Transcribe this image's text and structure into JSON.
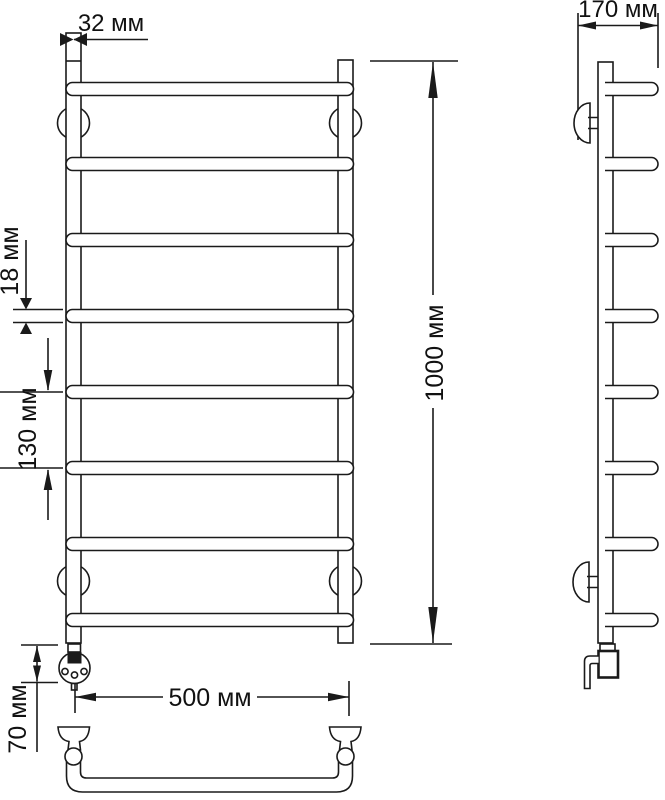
{
  "drawing": {
    "kind": "towel-rail-technical-drawing",
    "colors": {
      "line": "#1a1a1a",
      "background": "#ffffff"
    },
    "dimensions": {
      "tube_diameter": "32 мм",
      "depth": "170 мм",
      "height": "1000 мм",
      "rung_diameter": "18 мм",
      "rung_spacing": "130 мм",
      "width": "500 мм",
      "heater_offset": "70 мм"
    }
  }
}
